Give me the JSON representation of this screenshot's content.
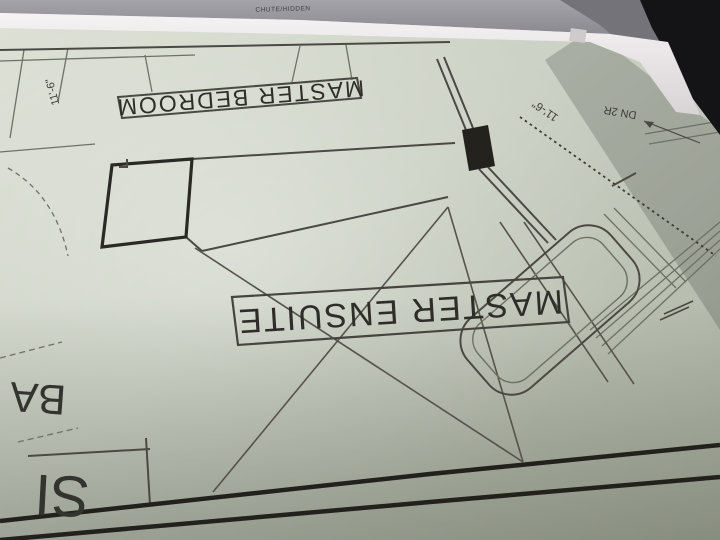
{
  "scene": {
    "kind": "photo of architectural floor plan, viewed rotated 180 degrees",
    "colors": {
      "paper_light": "#dce0d5",
      "paper_mid": "#cbd1c4",
      "paper_dark": "#a8ae9f",
      "gray_band": "#9d9ca2",
      "gray_band_dark": "#74737a",
      "background_black": "#141417",
      "roll_edge_white": "#f6f3f4",
      "line_thin": "#6e7166",
      "line_medium": "#4a4a43",
      "line_thick": "#22211c",
      "text_dark": "#2e2e29"
    }
  },
  "plan": {
    "rooms": [
      {
        "id": "master-bedroom",
        "label": "MASTER BEDROOM"
      },
      {
        "id": "master-ensuite",
        "label": "MASTER ENSUITE"
      }
    ],
    "annotations": {
      "chute_note": "CHUTE/HIDDEN",
      "stair_note": "DN 2R",
      "dim_top_left": "11'-6\"",
      "dim_right": "11'-6\"",
      "partial_label_1": "BA",
      "partial_label_2": "SI"
    },
    "fixtures": [
      {
        "id": "bathtub",
        "name": "freestanding bathtub"
      }
    ],
    "features": [
      "cross-bracing diagonals in ensuite",
      "dashed dimension line right side",
      "thick double bottom wall",
      "closet/wall block left of ensuite",
      "solid filled wall post"
    ]
  }
}
